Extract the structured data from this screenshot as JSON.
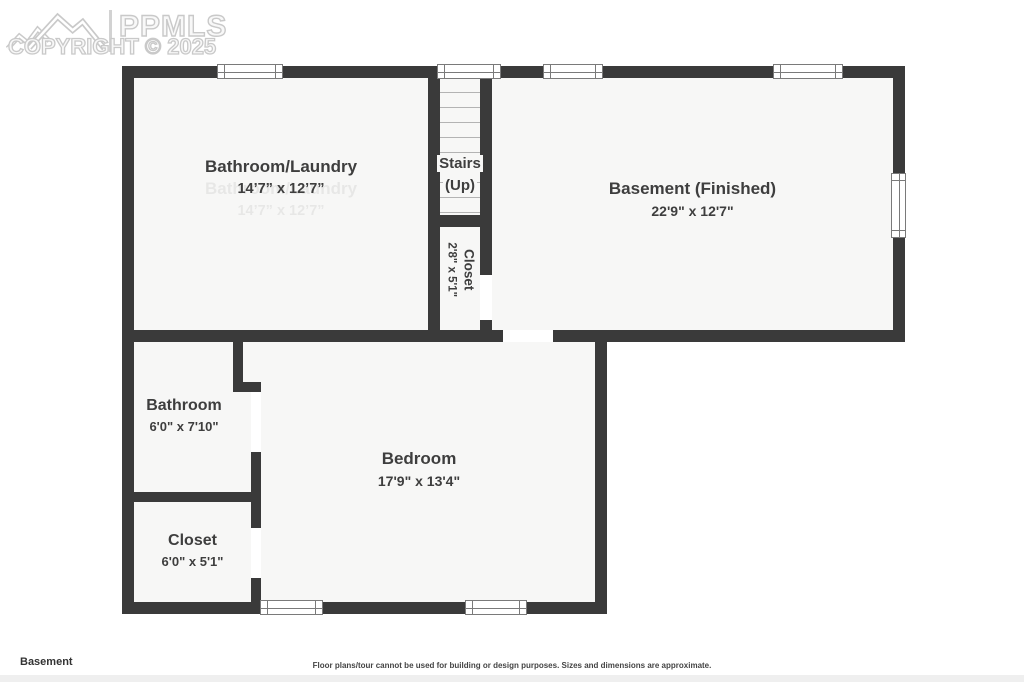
{
  "watermark": {
    "brand": "PPMLS",
    "copyright": "COPYRIGHT © 2025"
  },
  "plan": {
    "rooms": {
      "bathroom_laundry": {
        "name": "Bathroom/Laundry",
        "dims": "14’7” x 12’7”"
      },
      "basement_finished": {
        "name": "Basement (Finished)",
        "dims": "22'9\" x 12'7\""
      },
      "closet_small": {
        "name": "Closet",
        "dims": "2'8\" x 5'1\""
      },
      "bathroom": {
        "name": "Bathroom",
        "dims": "6'0\" x 7'10\""
      },
      "bedroom": {
        "name": "Bedroom",
        "dims": "17'9\" x 13'4\""
      },
      "closet_lower": {
        "name": "Closet",
        "dims": "6'0\" x 5'1\""
      }
    },
    "stairs": {
      "line1": "Stairs",
      "line2": "(Up)"
    }
  },
  "footer": {
    "floor": "Basement",
    "disclaimer": "Floor plans/tour cannot be used for building or design purposes. Sizes and dimensions are approximate."
  },
  "colors": {
    "wall": "#3a3a3a",
    "room_fill": "#f7f7f6",
    "watermark": "#c9c9c9",
    "label_text": "#3e3e3e"
  }
}
